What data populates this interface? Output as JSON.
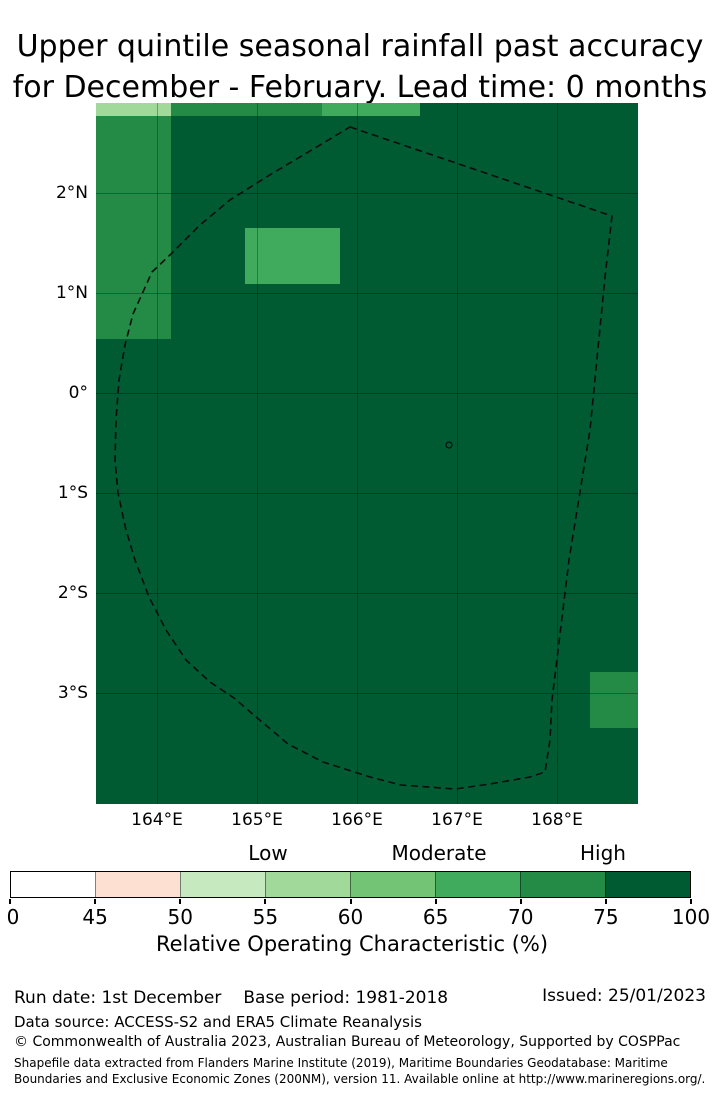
{
  "title": {
    "line1": "Upper quintile seasonal rainfall past accuracy",
    "line2": "for December - February. Lead time: 0 months"
  },
  "map": {
    "background_color": "#005a32",
    "gridline_color": "rgba(0,0,0,0.3)",
    "boundary_name": "Exclusive Economic Zone (dashed boundary)",
    "lat_ticks": [
      {
        "label": "2°N",
        "deg": 2
      },
      {
        "label": "1°N",
        "deg": 1
      },
      {
        "label": "0°",
        "deg": 0
      },
      {
        "label": "1°S",
        "deg": -1
      },
      {
        "label": "2°S",
        "deg": -2
      },
      {
        "label": "3°S",
        "deg": -3
      }
    ],
    "lon_ticks": [
      {
        "label": "164°E",
        "deg": 164
      },
      {
        "label": "165°E",
        "deg": 165
      },
      {
        "label": "166°E",
        "deg": 166
      },
      {
        "label": "167°E",
        "deg": 167
      },
      {
        "label": "168°E",
        "deg": 168
      }
    ],
    "cells": [
      {
        "lon_min": 163.39,
        "lon_max": 164.14,
        "lat_min": 2.77,
        "lat_max": 2.9,
        "roc_bin": "55-60",
        "color": "#a1d99b"
      },
      {
        "lon_min": 164.14,
        "lon_max": 165.65,
        "lat_min": 2.77,
        "lat_max": 2.9,
        "roc_bin": "70-75",
        "color": "#238b45"
      },
      {
        "lon_min": 165.65,
        "lon_max": 166.63,
        "lat_min": 2.77,
        "lat_max": 2.9,
        "roc_bin": "65-70",
        "color": "#41ab5d"
      },
      {
        "lon_min": 163.39,
        "lon_max": 164.14,
        "lat_min": 0.54,
        "lat_max": 2.77,
        "roc_bin": "70-75",
        "color": "#238b45"
      },
      {
        "lon_min": 164.88,
        "lon_max": 165.83,
        "lat_min": 1.09,
        "lat_max": 1.65,
        "roc_bin": "65-70",
        "color": "#41ab5d"
      },
      {
        "lon_min": 168.33,
        "lon_max": 168.81,
        "lat_min": -3.35,
        "lat_max": -2.79,
        "roc_bin": "70-75",
        "color": "#238b45"
      }
    ],
    "eez_boundary_points": [
      [
        254,
        24
      ],
      [
        516,
        113
      ],
      [
        509,
        174
      ],
      [
        494,
        327
      ],
      [
        473,
        457
      ],
      [
        456,
        597
      ],
      [
        454,
        637
      ],
      [
        449,
        669
      ],
      [
        434,
        674
      ],
      [
        394,
        681
      ],
      [
        359,
        686
      ],
      [
        305,
        682
      ],
      [
        274,
        674
      ],
      [
        227,
        659
      ],
      [
        192,
        641
      ],
      [
        166,
        619
      ],
      [
        138,
        595
      ],
      [
        114,
        579
      ],
      [
        90,
        557
      ],
      [
        70,
        527
      ],
      [
        53,
        494
      ],
      [
        39,
        457
      ],
      [
        30,
        427
      ],
      [
        22,
        390
      ],
      [
        19,
        357
      ],
      [
        20,
        317
      ],
      [
        23,
        277
      ],
      [
        29,
        242
      ],
      [
        37,
        211
      ],
      [
        56,
        169
      ],
      [
        75,
        151
      ],
      [
        104,
        122
      ],
      [
        134,
        97
      ],
      [
        172,
        73
      ],
      [
        209,
        51
      ]
    ],
    "island_marker": {
      "x": 353,
      "y": 342,
      "r": 3
    }
  },
  "colorbar": {
    "categories": [
      {
        "label": "Low",
        "x": 268
      },
      {
        "label": "Moderate",
        "x": 439
      },
      {
        "label": "High",
        "x": 603
      }
    ],
    "segment_colors": [
      "#ffffff",
      "#fee0d2",
      "#c7e9c0",
      "#a1d99b",
      "#74c476",
      "#41ab5d",
      "#238b45",
      "#005a32"
    ],
    "tick_labels": [
      "0",
      "45",
      "50",
      "55",
      "60",
      "65",
      "70",
      "75",
      "100"
    ],
    "axis_label": "Relative Operating Characteristic (%)"
  },
  "footer": {
    "run_date": "Run date: 1st December",
    "base_period": "Base period: 1981-2018",
    "issued": "Issued: 25/01/2023",
    "data_source": "Data source: ACCESS-S2 and ERA5 Climate Reanalysis",
    "copyright": "© Commonwealth of Australia 2023, Australian Bureau of Meteorology, Supported by COSPPac",
    "shapefile_line1": "Shapefile data extracted from Flanders Marine Institute (2019), Maritime Boundaries Geodatabase: Maritime",
    "shapefile_line2": "Boundaries and Exclusive Economic Zones (200NM), version 11. Available online at http://www.marineregions.org/."
  },
  "chart_data": {
    "type": "heatmap",
    "title": "Upper quintile seasonal rainfall past accuracy for December - February. Lead time: 0 months",
    "x_tick_labels": [
      "164°E",
      "165°E",
      "166°E",
      "167°E",
      "168°E"
    ],
    "y_tick_labels": [
      "2°N",
      "1°N",
      "0°",
      "1°S",
      "2°S",
      "3°S"
    ],
    "x_range_deg_east": [
      163.39,
      168.81
    ],
    "y_range_deg_north": [
      -4.11,
      2.9
    ],
    "colorbar": {
      "label": "Relative Operating Characteristic (%)",
      "tick_values": [
        0,
        45,
        50,
        55,
        60,
        65,
        70,
        75,
        100
      ],
      "bin_colors": [
        "#ffffff",
        "#fee0d2",
        "#c7e9c0",
        "#a1d99b",
        "#74c476",
        "#41ab5d",
        "#238b45",
        "#005a32"
      ],
      "category_labels": [
        "Low",
        "Moderate",
        "High"
      ],
      "category_center_values": [
        55,
        65,
        75
      ]
    },
    "background_value_bin": "75-100",
    "regions": [
      {
        "extent_deg": [
          163.39,
          164.14,
          2.77,
          2.9
        ],
        "roc_bin": "55-60"
      },
      {
        "extent_deg": [
          164.14,
          165.65,
          2.77,
          2.9
        ],
        "roc_bin": "70-75"
      },
      {
        "extent_deg": [
          165.65,
          166.63,
          2.77,
          2.9
        ],
        "roc_bin": "65-70"
      },
      {
        "extent_deg": [
          163.39,
          164.14,
          0.54,
          2.77
        ],
        "roc_bin": "70-75"
      },
      {
        "extent_deg": [
          164.88,
          165.83,
          1.09,
          1.65
        ],
        "roc_bin": "65-70"
      },
      {
        "extent_deg": [
          168.33,
          168.81,
          -3.35,
          -2.79
        ],
        "roc_bin": "70-75"
      }
    ],
    "overlay": "Dashed EEZ boundary polygon, small island marker near 167.0°E 0.5°S",
    "grid": true,
    "legend_position": "bottom colorbar"
  }
}
